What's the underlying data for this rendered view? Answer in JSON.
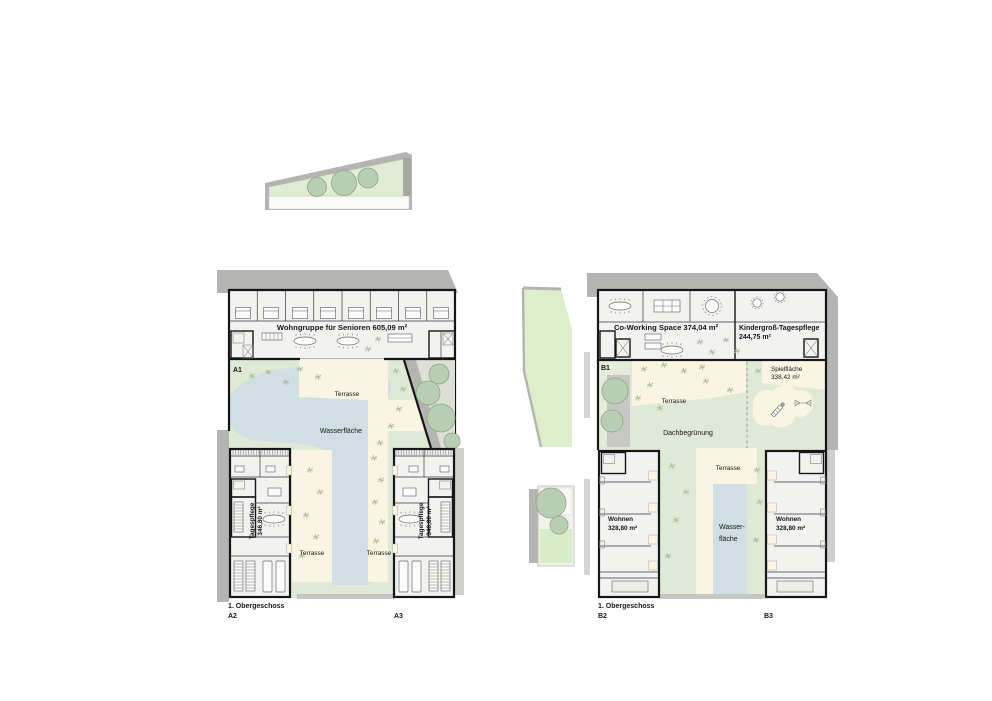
{
  "colors": {
    "shadow": "#b4b4b2",
    "shadow_light": "#cfcfcd",
    "lawn": "#dfe9d5",
    "lawn_pale": "#e3edd9",
    "mid_green": "#ddeecb",
    "cream": "#faf5e2",
    "water": "#cfdfe3",
    "tree_fill": "#b9cfb3",
    "tree_stroke": "#8ba686",
    "room_fill": "#f2f2f0",
    "wall": "#161616"
  },
  "shared": {
    "floor_label": "1. Obergeschoss",
    "terrasse": "Terrasse",
    "dachbegruenung": "Dachbegrünung"
  },
  "complex_a": {
    "id_a1": "A1",
    "id_a2": "A2",
    "id_a3": "A3",
    "wohngruppe": "Wohngruppe für Senioren 605,09 m²",
    "wasserflaeche": "Wasserfläche",
    "tagespflege_name": "Tagespflege",
    "tagespflege_area": "346,80 m²"
  },
  "complex_b": {
    "id_b1": "B1",
    "id_b2": "B2",
    "id_b3": "B3",
    "coworking": "Co-Working Space 374,04 m²",
    "kindergross_name": "Kindergroß-Tagespflege",
    "kindergross_area": "244,75 m²",
    "spielflaeche_name": "Spielfläche",
    "spielflaeche_area": "338,42 m²",
    "wohnen_name": "Wohnen",
    "wohnen_area": "328,80 m²",
    "wasser_line1": "Wasser-",
    "wasser_line2": "fläche"
  }
}
